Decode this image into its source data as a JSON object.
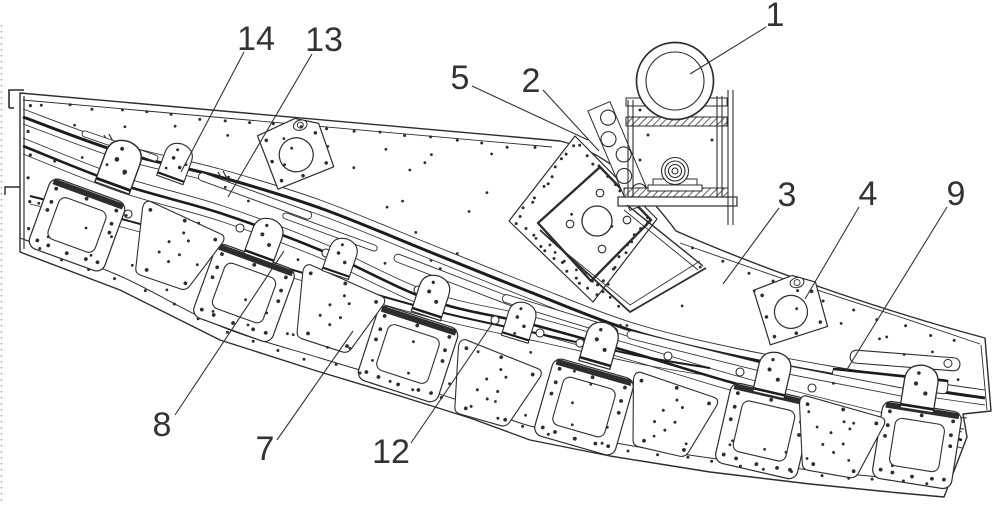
{
  "figure": {
    "colors": {
      "line": "#2d2d2d",
      "thick_line": "#1c1c1c",
      "background": "#ffffff",
      "label": "#333333"
    }
  },
  "callouts": [
    {
      "label": "1",
      "tx": 775,
      "ty": 15,
      "x1": 766,
      "y1": 27,
      "x2": 690,
      "y2": 74
    },
    {
      "label": "2",
      "tx": 531,
      "ty": 81,
      "x1": 543,
      "y1": 90,
      "x2": 599,
      "y2": 151
    },
    {
      "label": "3",
      "tx": 787,
      "ty": 195,
      "x1": 779,
      "y1": 208,
      "x2": 723,
      "y2": 284
    },
    {
      "label": "4",
      "tx": 868,
      "ty": 194,
      "x1": 859,
      "y1": 207,
      "x2": 805,
      "y2": 299
    },
    {
      "label": "5",
      "tx": 460,
      "ty": 78,
      "x1": 472,
      "y1": 86,
      "x2": 588,
      "y2": 140
    },
    {
      "label": "7",
      "tx": 265,
      "ty": 449,
      "x1": 277,
      "y1": 440,
      "x2": 353,
      "y2": 331
    },
    {
      "label": "8",
      "tx": 162,
      "ty": 425,
      "x1": 175,
      "y1": 415,
      "x2": 284,
      "y2": 251
    },
    {
      "label": "9",
      "tx": 956,
      "ty": 194,
      "x1": 947,
      "y1": 207,
      "x2": 846,
      "y2": 371
    },
    {
      "label": "12",
      "tx": 391,
      "ty": 452,
      "x1": 411,
      "y1": 443,
      "x2": 492,
      "y2": 324
    },
    {
      "label": "13",
      "tx": 324,
      "ty": 40,
      "x1": 312,
      "y1": 54,
      "x2": 228,
      "y2": 197
    },
    {
      "label": "14",
      "tx": 256,
      "ty": 39,
      "x1": 244,
      "y1": 52,
      "x2": 181,
      "y2": 172
    }
  ]
}
